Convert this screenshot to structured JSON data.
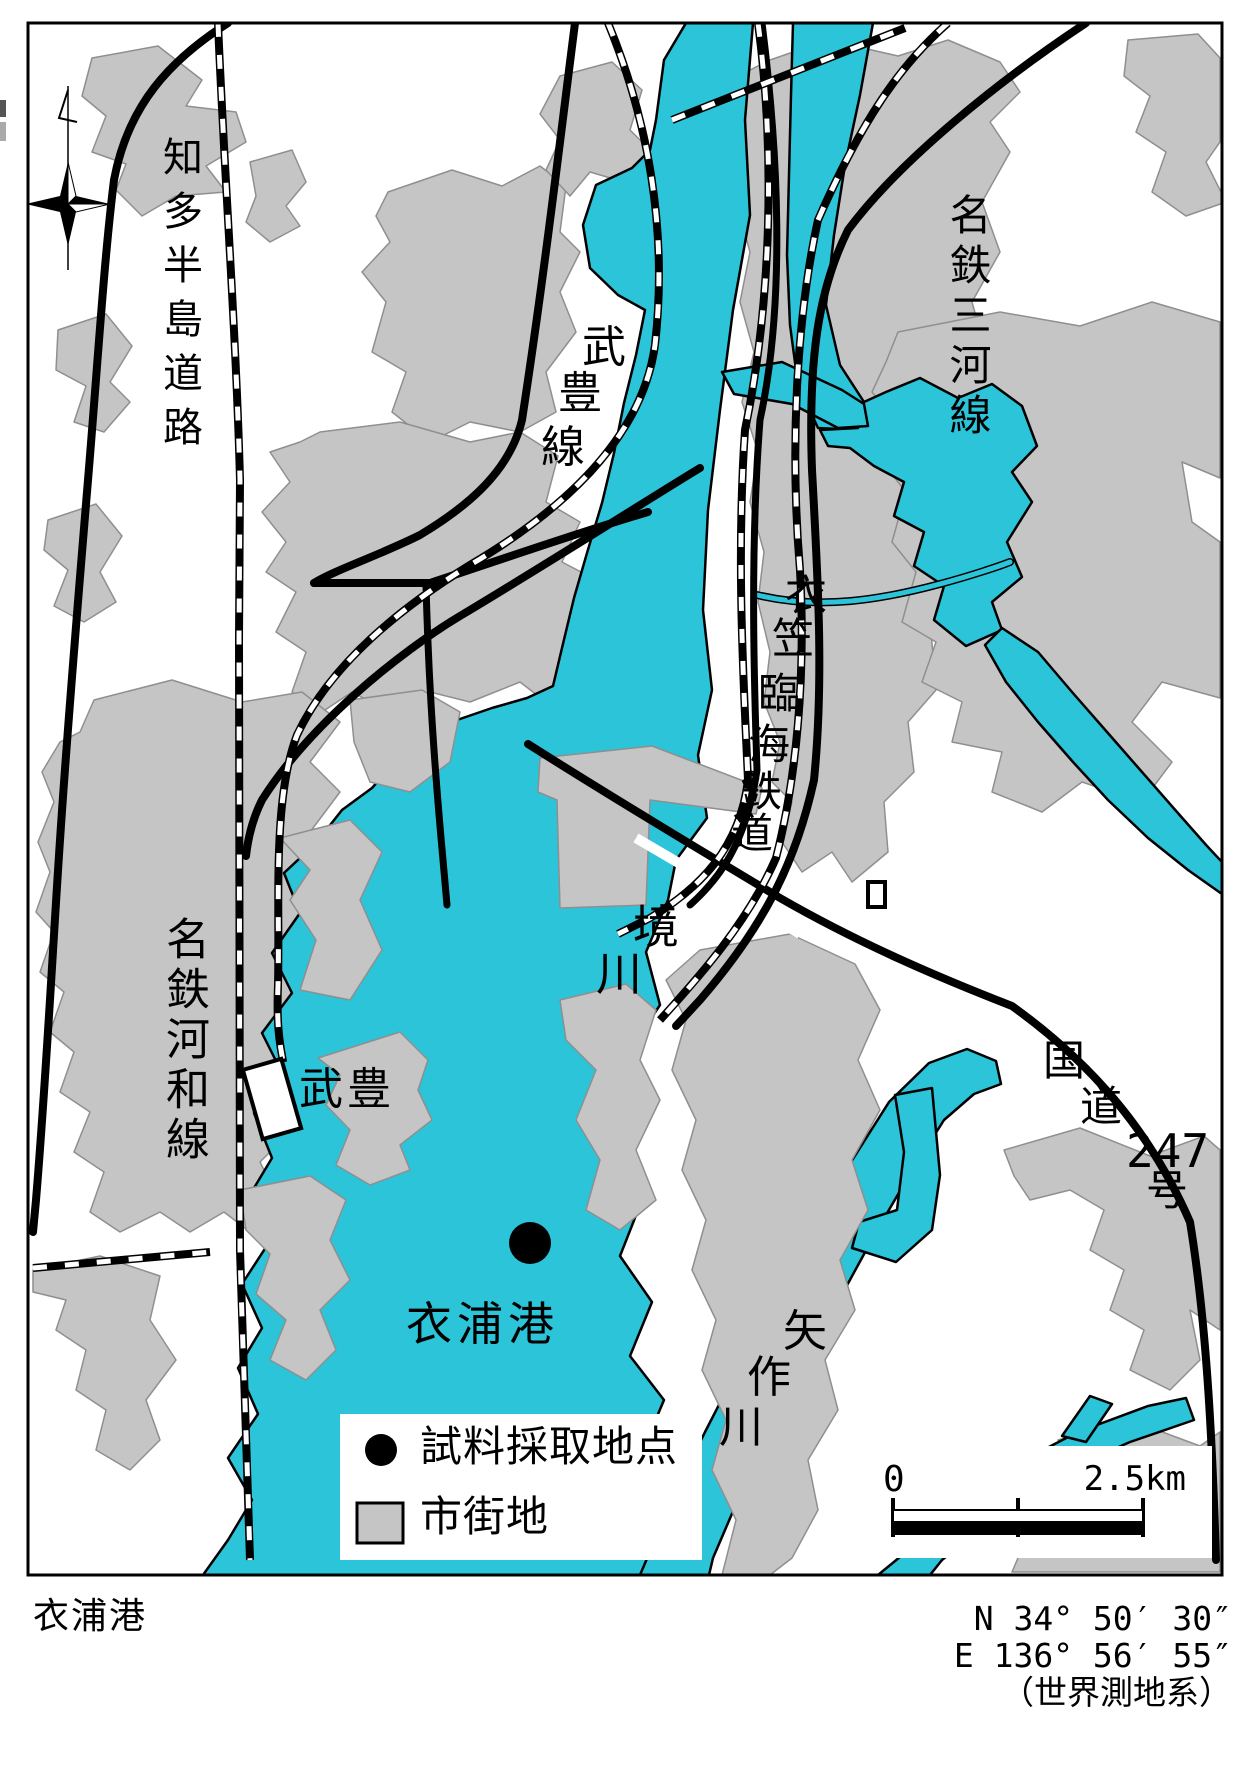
{
  "labels": {
    "chita_road": "知多半島道路",
    "taketoyo_line": "武豊線",
    "taketoyo_line_chars": [
      "武",
      "豊",
      "線"
    ],
    "mikawa_line": "名鉄三河線",
    "rinkai_railway": "衣笠臨海鉄道",
    "rinkai_railway_chars": [
      "衣",
      "笠",
      "臨",
      "海",
      "鉄",
      "道"
    ],
    "sakai_river": "境川",
    "sakai_river_chars": [
      "境",
      "川"
    ],
    "kowa_line": "名鉄河和線",
    "taketoyo_station": "武豊",
    "route247": "国道247号",
    "route247_parts": {
      "k1": "国",
      "k2": "道",
      "num": "247",
      "k3": "号"
    },
    "kinuura_port": "衣浦港",
    "yahagi_river": "矢作川",
    "yahagi_river_chars": [
      "矢",
      "作",
      "川"
    ]
  },
  "legend": {
    "sample_point": "試料採取地点",
    "urban_area": "市街地"
  },
  "scalebar": {
    "start": "0",
    "end": "2.5km"
  },
  "footer": {
    "title": "衣浦港",
    "latitude": "N  34°  50′  30″",
    "longitude": "E 136°  56′  55″",
    "datum": "（世界測地系）"
  },
  "icons": {
    "compass": "compass-rose",
    "sample_point": "black-dot",
    "station": "white-station-box"
  },
  "colors": {
    "water": "#2bc4d9",
    "urban": "#c5c5c5",
    "line": "#000000"
  }
}
